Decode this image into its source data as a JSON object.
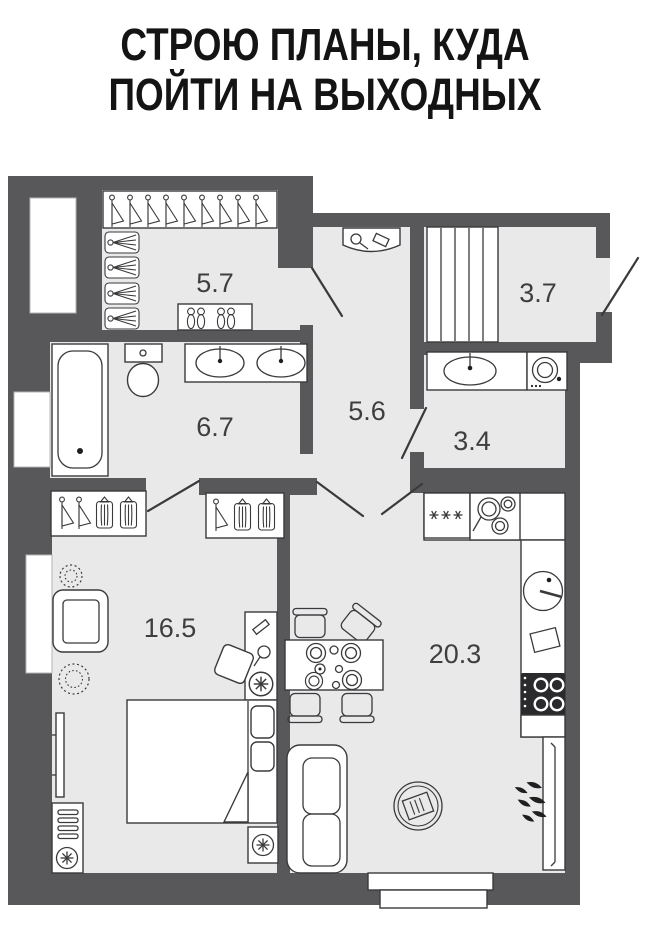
{
  "title": {
    "line1": "СТРОЮ ПЛАНЫ, КУДА",
    "line2": "ПОЙТИ НА ВЫХОДНЫХ"
  },
  "floorplan": {
    "rooms": {
      "walk_in_closet": {
        "area": "5.7"
      },
      "entry_hall": {
        "area": "3.7"
      },
      "bathroom": {
        "area": "6.7"
      },
      "hallway": {
        "area": "5.6"
      },
      "wc_laundry": {
        "area": "3.4"
      },
      "bedroom": {
        "area": "16.5"
      },
      "kitchen_living": {
        "area": "20.3"
      }
    },
    "colors": {
      "wall": "#58585a",
      "floor": "#e9e9ea",
      "line": "#3a3a3c"
    }
  }
}
